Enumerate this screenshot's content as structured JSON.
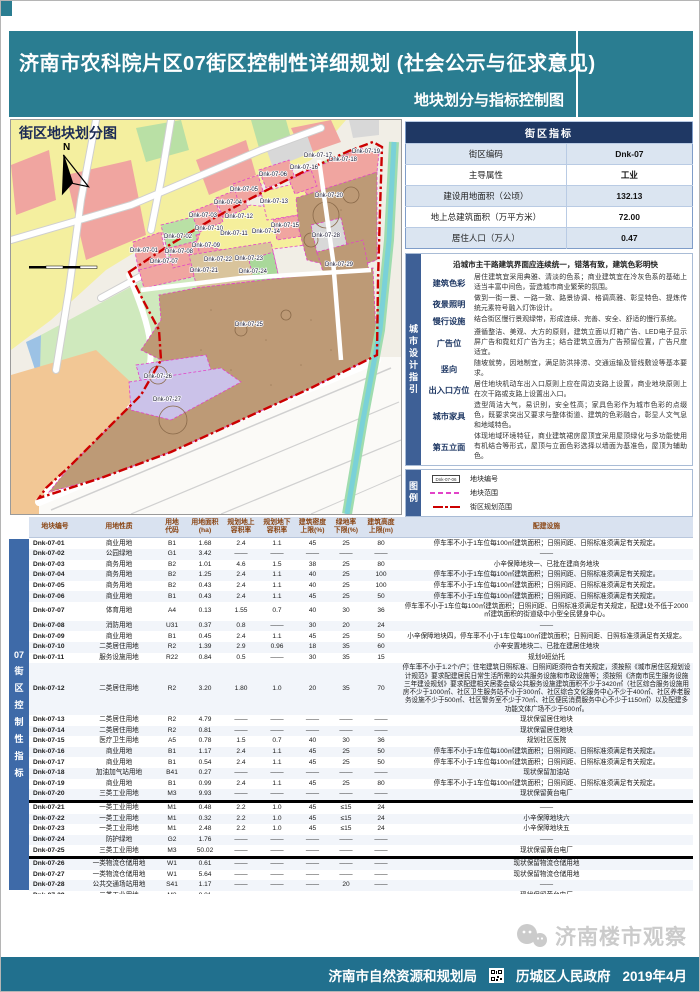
{
  "page": {
    "title": "济南市农科院片区07街区控制性详细规划 (社会公示与征求意见)",
    "subtitle": "地块划分与指标控制图"
  },
  "map": {
    "title": "街区地块划分图",
    "north_label": "N",
    "plots": [
      {
        "id": "Dnk-07-01",
        "x": 133,
        "y": 132
      },
      {
        "id": "Dnk-07-02",
        "x": 167,
        "y": 118
      },
      {
        "id": "Dnk-07-03",
        "x": 192,
        "y": 97
      },
      {
        "id": "Dnk-07-04",
        "x": 217,
        "y": 84
      },
      {
        "id": "Dnk-07-05",
        "x": 233,
        "y": 71
      },
      {
        "id": "Dnk-07-06",
        "x": 262,
        "y": 56
      },
      {
        "id": "Dnk-07-07",
        "x": 153,
        "y": 143
      },
      {
        "id": "Dnk-07-08",
        "x": 168,
        "y": 133
      },
      {
        "id": "Dnk-07-09",
        "x": 195,
        "y": 127
      },
      {
        "id": "Dnk-07-10",
        "x": 198,
        "y": 110
      },
      {
        "id": "Dnk-07-11",
        "x": 223,
        "y": 115
      },
      {
        "id": "Dnk-07-12",
        "x": 228,
        "y": 98
      },
      {
        "id": "Dnk-07-13",
        "x": 263,
        "y": 83
      },
      {
        "id": "Dnk-07-14",
        "x": 255,
        "y": 113
      },
      {
        "id": "Dnk-07-15",
        "x": 274,
        "y": 107
      },
      {
        "id": "Dnk-07-16",
        "x": 293,
        "y": 49
      },
      {
        "id": "Dnk-07-17",
        "x": 307,
        "y": 37
      },
      {
        "id": "Dnk-07-18",
        "x": 332,
        "y": 41
      },
      {
        "id": "Dnk-07-19",
        "x": 355,
        "y": 33
      },
      {
        "id": "Dnk-07-20",
        "x": 318,
        "y": 77
      },
      {
        "id": "Dnk-07-21",
        "x": 193,
        "y": 152
      },
      {
        "id": "Dnk-07-22",
        "x": 207,
        "y": 141
      },
      {
        "id": "Dnk-07-23",
        "x": 238,
        "y": 140
      },
      {
        "id": "Dnk-07-24",
        "x": 242,
        "y": 153
      },
      {
        "id": "Dnk-07-25",
        "x": 238,
        "y": 206
      },
      {
        "id": "Dnk-07-26",
        "x": 147,
        "y": 258
      },
      {
        "id": "Dnk-07-27",
        "x": 156,
        "y": 281
      },
      {
        "id": "Dnk-07-28",
        "x": 315,
        "y": 117
      },
      {
        "id": "Dnk-07-29",
        "x": 328,
        "y": 146
      }
    ]
  },
  "indicators": {
    "title": "街区指标",
    "rows": [
      {
        "label": "街区编码",
        "value": "Dnk-07"
      },
      {
        "label": "主导属性",
        "value": "工业"
      },
      {
        "label": "建设用地面积（公顷）",
        "value": "132.13"
      },
      {
        "label": "地上总建筑面积（万平方米）",
        "value": "72.00"
      },
      {
        "label": "居住人口（万人）",
        "value": "0.47"
      }
    ]
  },
  "design_guide": {
    "side_label": "城市设计指引",
    "intro": "沿城市主干路建筑界面应连续统一，错落有致，建筑色彩明快",
    "items": [
      {
        "label": "建筑色彩",
        "text": "居住建筑宜采用典雅、清淡的色系；商业建筑宜在冷灰色系的基础上适当丰富中间色，营造城市商业繁荣的氛围。"
      },
      {
        "label": "夜景照明",
        "text": "做到一街一景、一路一致、路景协调、格调高雅、彰显特色、提炼传统元素符号融入灯饰设计。"
      },
      {
        "label": "慢行设施",
        "text": "结合街区慢行景观绿带，形成连续、完善、安全、舒适的慢行系统。"
      },
      {
        "label": "广告位",
        "text": "遵循整洁、美观、大方的原则，建筑立面以灯箱广告、LED电子显示屏广告和霓虹灯广告为主；结合建筑立面为广告预留位置，广告尺度适宜。"
      },
      {
        "label": "竖向",
        "text": "随坡就势，因地制宜，满足防洪排涝、交通运输及管线敷设等基本要求。"
      },
      {
        "label": "出入口方位",
        "text": "居住地块机动车出入口原则上应在周边支路上设置，商业地块原则上在次干路或支路上设置出入口。"
      },
      {
        "label": "城市家具",
        "text": "造型简洁大气，易识别，安全性高；家具色彩作为城市色彩的点缀色，既要求突出又要求与整体街道、建筑的色彩融合，彰显人文气息和地域特色。"
      },
      {
        "label": "第五立面",
        "text": "体现地域环境特征，商业建筑裙房屋顶宜采用屋顶绿化与多功能使用有机结合等形式，屋顶与立面色彩选择以墙面为基准色，屋顶为辅助色。"
      }
    ]
  },
  "legend": {
    "side_label": "图例",
    "items": [
      {
        "symbol": "plot-code-box",
        "sample": "Dnk-07-06",
        "label": "地块编号"
      },
      {
        "symbol": "magenta-dashed-line",
        "label": "地块范围"
      },
      {
        "symbol": "red-dashdot-line",
        "label": "街区规划范围"
      }
    ]
  },
  "table": {
    "side_label_lines": [
      "07",
      "街",
      "区",
      "控",
      "制",
      "性",
      "指",
      "标"
    ],
    "headers": [
      "地块编号",
      "用地性质",
      "用地\n代码",
      "用地面积\n(ha)",
      "规划地上\n容积率",
      "规划地下\n容积率",
      "建筑密度\n上限(%)",
      "绿地率\n下限(%)",
      "建筑高度\n上限(m)",
      "配建设施"
    ],
    "underlined_rows": [
      "Dnk-07-20",
      "Dnk-07-25",
      "Dnk-07-29"
    ],
    "rows": [
      [
        "Dnk-07-01",
        "商业用地",
        "B1",
        "1.68",
        "2.4",
        "1.1",
        "45",
        "25",
        "80",
        "停车率不小于1车位每100㎡建筑面积；日照间距、日照标准须满足有关规定。"
      ],
      [
        "Dnk-07-02",
        "公园绿地",
        "G1",
        "3.42",
        "——",
        "——",
        "——",
        "——",
        "——",
        "——"
      ],
      [
        "Dnk-07-03",
        "商务用地",
        "B2",
        "1.01",
        "4.6",
        "1.5",
        "38",
        "25",
        "80",
        "小辛保障地块一、已批在建商务地块"
      ],
      [
        "Dnk-07-04",
        "商务用地",
        "B2",
        "1.25",
        "2.4",
        "1.1",
        "40",
        "25",
        "100",
        "停车率不小于1车位每100㎡建筑面积；日照间距、日照标准须满足有关规定。"
      ],
      [
        "Dnk-07-05",
        "商务用地",
        "B2",
        "0.43",
        "2.4",
        "1.1",
        "40",
        "25",
        "100",
        "停车率不小于1车位每100㎡建筑面积；日照间距、日照标准须满足有关规定。"
      ],
      [
        "Dnk-07-06",
        "商业用地",
        "B1",
        "0.43",
        "2.4",
        "1.1",
        "45",
        "25",
        "50",
        "停车率不小于1车位每100㎡建筑面积；日照间距、日照标准须满足有关规定。"
      ],
      [
        "Dnk-07-07",
        "体育用地",
        "A4",
        "0.13",
        "1.55",
        "0.7",
        "40",
        "30",
        "36",
        "停车率不小于1车位每100㎡建筑面积；日照间距、日照标准须满足有关规定，配建1处不低于2000㎡建筑面积的街道级中小型全民健身中心。"
      ],
      [
        "Dnk-07-08",
        "消防用地",
        "U31",
        "0.37",
        "0.8",
        "——",
        "30",
        "20",
        "24",
        "——"
      ],
      [
        "Dnk-07-09",
        "商业用地",
        "B1",
        "0.45",
        "2.4",
        "1.1",
        "45",
        "25",
        "50",
        "小辛保障地块四，停车率不小于1车位每100㎡建筑面积；日照间距、日照标准须满足有关规定。"
      ],
      [
        "Dnk-07-10",
        "二类居住用地",
        "R2",
        "1.39",
        "2.9",
        "0.96",
        "18",
        "35",
        "60",
        "小辛安置地块二、已批在建居住地块"
      ],
      [
        "Dnk-07-11",
        "服务设施用地",
        "R22",
        "0.84",
        "0.5",
        "——",
        "30",
        "35",
        "15",
        "规划9班幼托"
      ],
      [
        "Dnk-07-12",
        "二类居住用地",
        "R2",
        "3.20",
        "1.80",
        "1.0",
        "20",
        "35",
        "70",
        "停车率不小于1.2个/户；住宅建筑日照标准、日照间距须符合有关规定，须按照《城市居住区规划设计规范》要求配建居民日常生活所需的公共服务设施和市政设施等；须按照《济南市民生服务设施三年建设规划》要求配建相关居委会级公共服务设施建筑面积不少于3420㎡（社区综合服务设施用房不少于1000㎡、社区卫生服务站不小于300㎡、社区综合文化服务中心不少于400㎡、社区养老服务设施不少于500㎡、社区警务室不少于70㎡、社区便民消费服务中心不少于1150㎡）以及配建多功能文体广场不少于500㎡。"
      ],
      [
        "Dnk-07-13",
        "二类居住用地",
        "R2",
        "4.79",
        "——",
        "——",
        "——",
        "——",
        "——",
        "现状保留居住地块"
      ],
      [
        "Dnk-07-14",
        "二类居住用地",
        "R2",
        "0.81",
        "——",
        "——",
        "——",
        "——",
        "——",
        "现状保留居住地块"
      ],
      [
        "Dnk-07-15",
        "医疗卫生用地",
        "A5",
        "0.78",
        "1.5",
        "0.7",
        "40",
        "30",
        "36",
        "规划社区医院"
      ],
      [
        "Dnk-07-16",
        "商业用地",
        "B1",
        "1.17",
        "2.4",
        "1.1",
        "45",
        "25",
        "50",
        "停车率不小于1车位每100㎡建筑面积；日照间距、日照标准须满足有关规定。"
      ],
      [
        "Dnk-07-17",
        "商业用地",
        "B1",
        "0.54",
        "2.4",
        "1.1",
        "45",
        "25",
        "50",
        "停车率不小于1车位每100㎡建筑面积；日照间距、日照标准须满足有关规定。"
      ],
      [
        "Dnk-07-18",
        "加油加气站用地",
        "B41",
        "0.27",
        "——",
        "——",
        "——",
        "——",
        "——",
        "现状保留加油站"
      ],
      [
        "Dnk-07-19",
        "商业用地",
        "B1",
        "0.99",
        "2.4",
        "1.1",
        "45",
        "25",
        "80",
        "停车率不小于1车位每100㎡建筑面积；日照间距、日照标准须满足有关规定。"
      ],
      [
        "Dnk-07-20",
        "三类工业用地",
        "M3",
        "9.93",
        "——",
        "——",
        "——",
        "——",
        "——",
        "现状保留黄台电厂"
      ],
      [
        "Dnk-07-21",
        "一类工业用地",
        "M1",
        "0.48",
        "2.2",
        "1.0",
        "45",
        "≤15",
        "24",
        "——"
      ],
      [
        "Dnk-07-22",
        "一类工业用地",
        "M1",
        "0.32",
        "2.2",
        "1.0",
        "45",
        "≤15",
        "24",
        "小辛保障地块六"
      ],
      [
        "Dnk-07-23",
        "一类工业用地",
        "M1",
        "2.48",
        "2.2",
        "1.0",
        "45",
        "≤15",
        "24",
        "小辛保障地块五"
      ],
      [
        "Dnk-07-24",
        "防护绿地",
        "G2",
        "1.76",
        "——",
        "——",
        "——",
        "——",
        "——",
        "——"
      ],
      [
        "Dnk-07-25",
        "三类工业用地",
        "M3",
        "50.02",
        "——",
        "——",
        "——",
        "——",
        "——",
        "现状保留黄台电厂"
      ],
      [
        "Dnk-07-26",
        "一类物流仓储用地",
        "W1",
        "0.61",
        "——",
        "——",
        "——",
        "——",
        "——",
        "现状保留物流仓储用地"
      ],
      [
        "Dnk-07-27",
        "一类物流仓储用地",
        "W1",
        "5.64",
        "——",
        "——",
        "——",
        "——",
        "——",
        "现状保留物流仓储用地"
      ],
      [
        "Dnk-07-28",
        "公共交通场站用地",
        "S41",
        "1.17",
        "——",
        "——",
        "——",
        "20",
        "——",
        "——"
      ],
      [
        "Dnk-07-29",
        "三类工业用地",
        "M3",
        "8.81",
        "——",
        "——",
        "——",
        "——",
        "——",
        "现状保留黄台电厂"
      ]
    ]
  },
  "footer": {
    "agency1": "济南市自然资源和规划局",
    "agency2": "历城区人民政府",
    "date": "2019年4月",
    "watermark": "济南楼市观察"
  },
  "colors": {
    "header_teal": "#2a7d91",
    "footer_teal": "#21708e",
    "navy": "#1f3864",
    "sidebar_blue": "#3e6096",
    "boundary_red": "#cc0000",
    "parcel_magenta": "#e243c8"
  }
}
